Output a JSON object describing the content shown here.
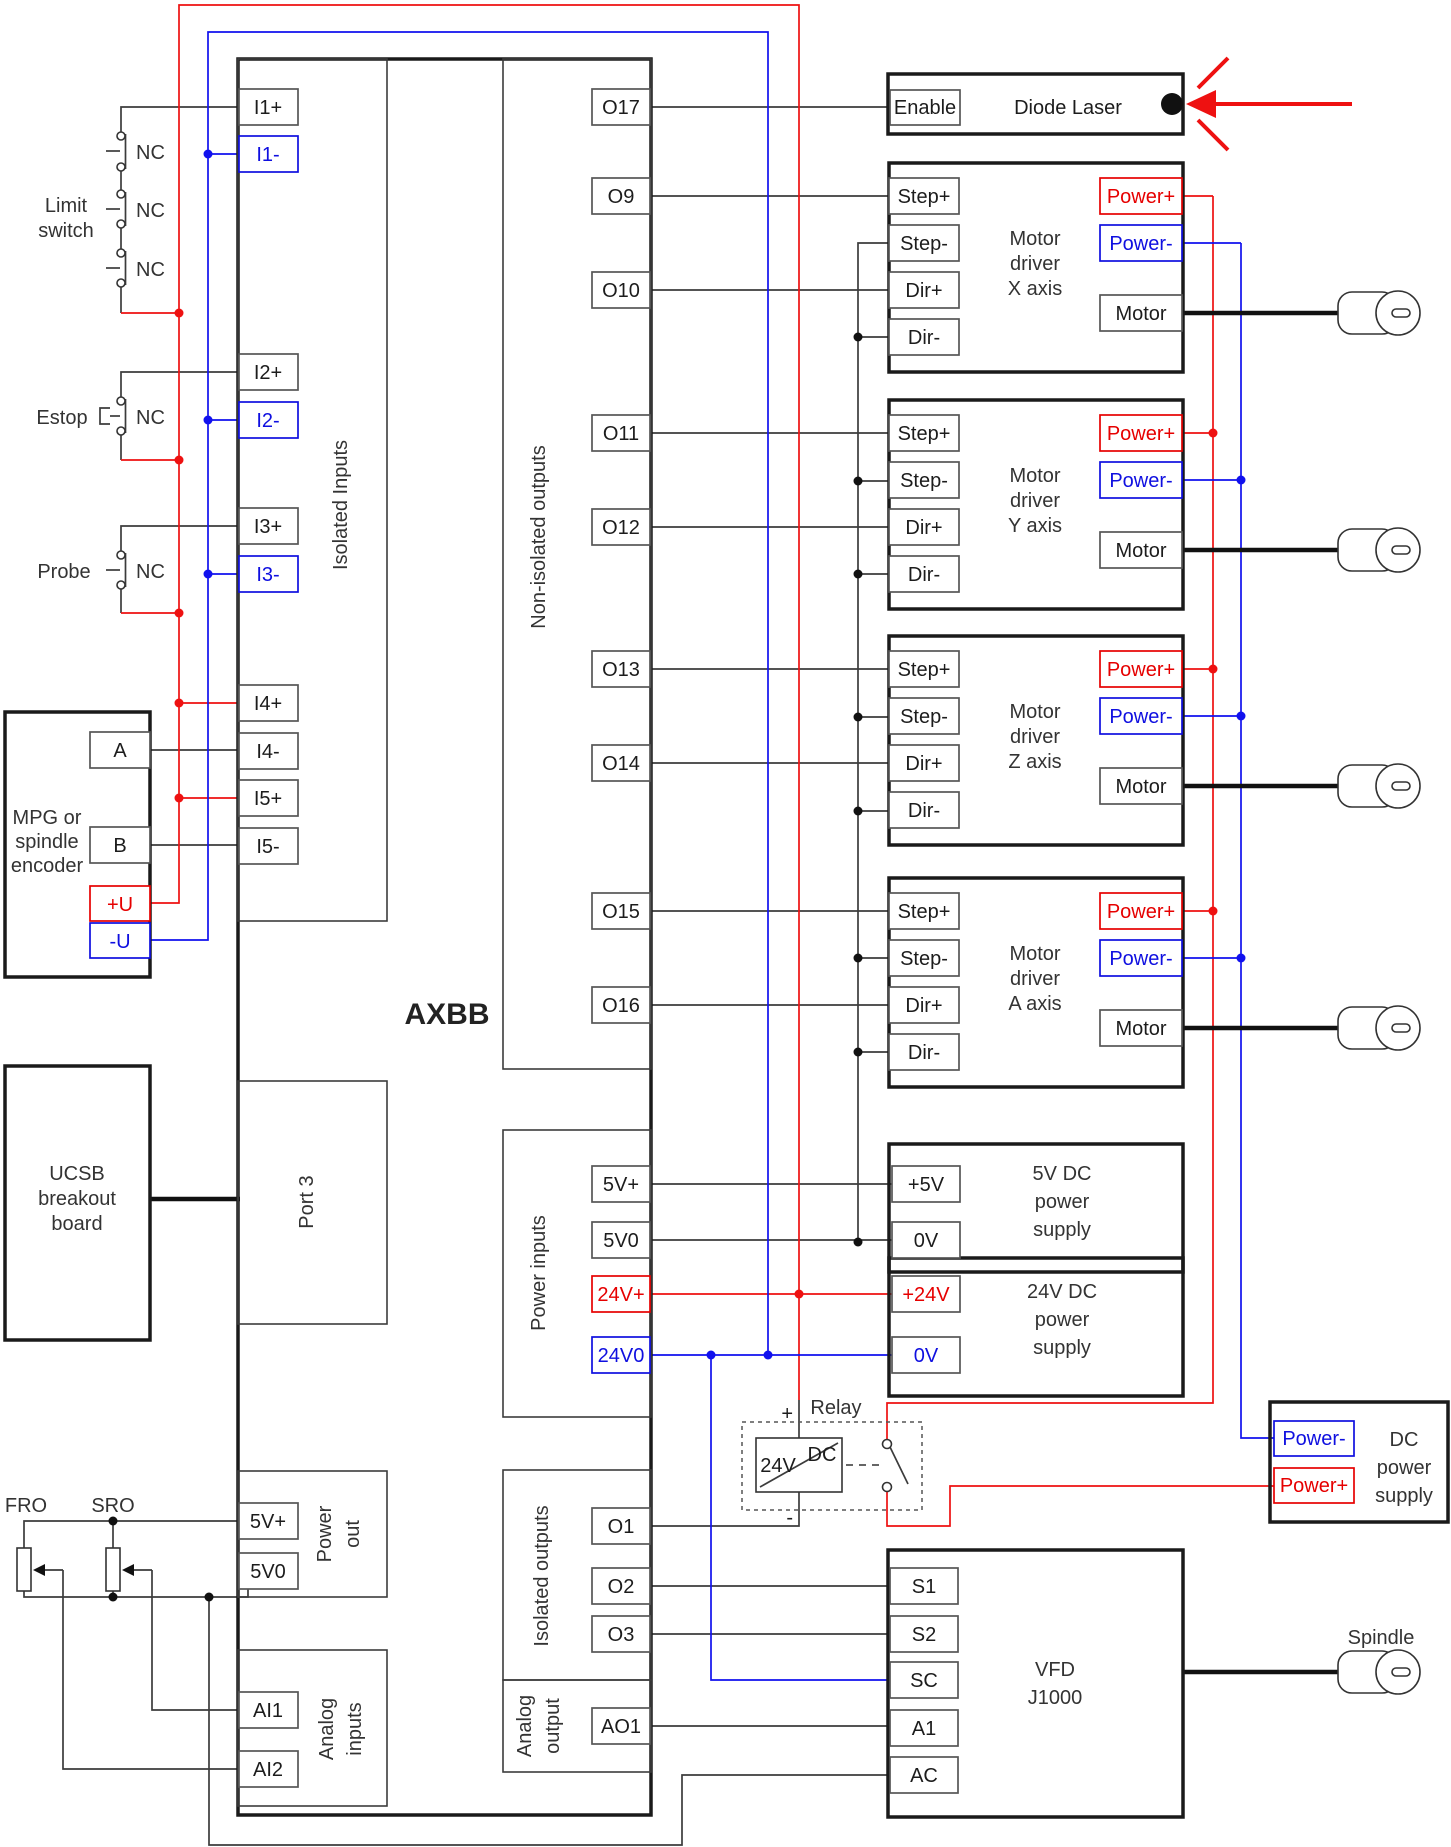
{
  "board": {
    "label": "AXBB",
    "sections": {
      "isolated_inputs": "Isolated Inputs",
      "non_isolated_outputs": "Non-isolated outputs",
      "port3": "Port 3",
      "power_inputs": "Power inputs",
      "power_out": {
        "lines": [
          "Power",
          "out"
        ]
      },
      "isolated_outputs": "Isolated outputs",
      "analog_output": {
        "lines": [
          "Analog",
          "output"
        ]
      },
      "analog_inputs": {
        "lines": [
          "Analog",
          "inputs"
        ]
      }
    }
  },
  "t": {
    "i1p": "I1+",
    "i1m": "I1-",
    "i2p": "I2+",
    "i2m": "I2-",
    "i3p": "I3+",
    "i3m": "I3-",
    "i4p": "I4+",
    "i4m": "I4-",
    "i5p": "I5+",
    "i5m": "I5-",
    "o17": "O17",
    "o9": "O9",
    "o10": "O10",
    "o11": "O11",
    "o12": "O12",
    "o13": "O13",
    "o14": "O14",
    "o15": "O15",
    "o16": "O16",
    "pv5p": "5V+",
    "pv50": "5V0",
    "pv24p": "24V+",
    "pv240": "24V0",
    "o1": "O1",
    "o2": "O2",
    "o3": "O3",
    "ao1": "AO1",
    "out5p": "5V+",
    "out50": "5V0",
    "ai1": "AI1",
    "ai2": "AI2"
  },
  "left": {
    "limit_switch": {
      "lines": [
        "Limit",
        "switch"
      ],
      "contacts": [
        "NC",
        "NC",
        "NC"
      ]
    },
    "estop": {
      "label": "Estop",
      "contact": "NC"
    },
    "probe": {
      "label": "Probe",
      "contact": "NC"
    },
    "mpg": {
      "lines": [
        "MPG or",
        "spindle",
        "encoder"
      ],
      "a": "A",
      "b": "B",
      "up": "+U",
      "um": "-U"
    },
    "ucsb": {
      "lines": [
        "UCSB",
        "breakout",
        "board"
      ]
    },
    "fro": "FRO",
    "sro": "SRO"
  },
  "laser": {
    "label": "Diode Laser",
    "enable": "Enable"
  },
  "drivers": [
    {
      "lines": [
        "Motor",
        "driver",
        "X axis"
      ],
      "step_plus": "Step+",
      "step_minus": "Step-",
      "dir_plus": "Dir+",
      "dir_minus": "Dir-",
      "pow_plus": "Power+",
      "pow_minus": "Power-",
      "motor": "Motor"
    },
    {
      "lines": [
        "Motor",
        "driver",
        "Y axis"
      ],
      "step_plus": "Step+",
      "step_minus": "Step-",
      "dir_plus": "Dir+",
      "dir_minus": "Dir-",
      "pow_plus": "Power+",
      "pow_minus": "Power-",
      "motor": "Motor"
    },
    {
      "lines": [
        "Motor",
        "driver",
        "Z axis"
      ],
      "step_plus": "Step+",
      "step_minus": "Step-",
      "dir_plus": "Dir+",
      "dir_minus": "Dir-",
      "pow_plus": "Power+",
      "pow_minus": "Power-",
      "motor": "Motor"
    },
    {
      "lines": [
        "Motor",
        "driver",
        "A axis"
      ],
      "step_plus": "Step+",
      "step_minus": "Step-",
      "dir_plus": "Dir+",
      "dir_minus": "Dir-",
      "pow_plus": "Power+",
      "pow_minus": "Power-",
      "motor": "Motor"
    }
  ],
  "supply5": {
    "plus": "+5V",
    "zero": "0V",
    "lines": [
      "5V DC",
      "power",
      "supply"
    ]
  },
  "supply24": {
    "plus": "+24V",
    "zero": "0V",
    "lines": [
      "24V DC",
      "power",
      "supply"
    ]
  },
  "relay": {
    "label": "Relay",
    "coil_left": "24V",
    "coil_right": "DC",
    "plus": "+",
    "minus": "-"
  },
  "dc_supply": {
    "pow_minus": "Power-",
    "pow_plus": "Power+",
    "lines": [
      "DC",
      "power",
      "supply"
    ]
  },
  "vfd": {
    "s1": "S1",
    "s2": "S2",
    "sc": "SC",
    "a1": "A1",
    "ac": "AC",
    "lines": [
      "VFD",
      "J1000"
    ]
  },
  "spindle": {
    "label": "Spindle"
  },
  "colors": {
    "power_positive": "#ee1111",
    "power_negative": "#1111ee",
    "signal": "#3c3c3c"
  }
}
